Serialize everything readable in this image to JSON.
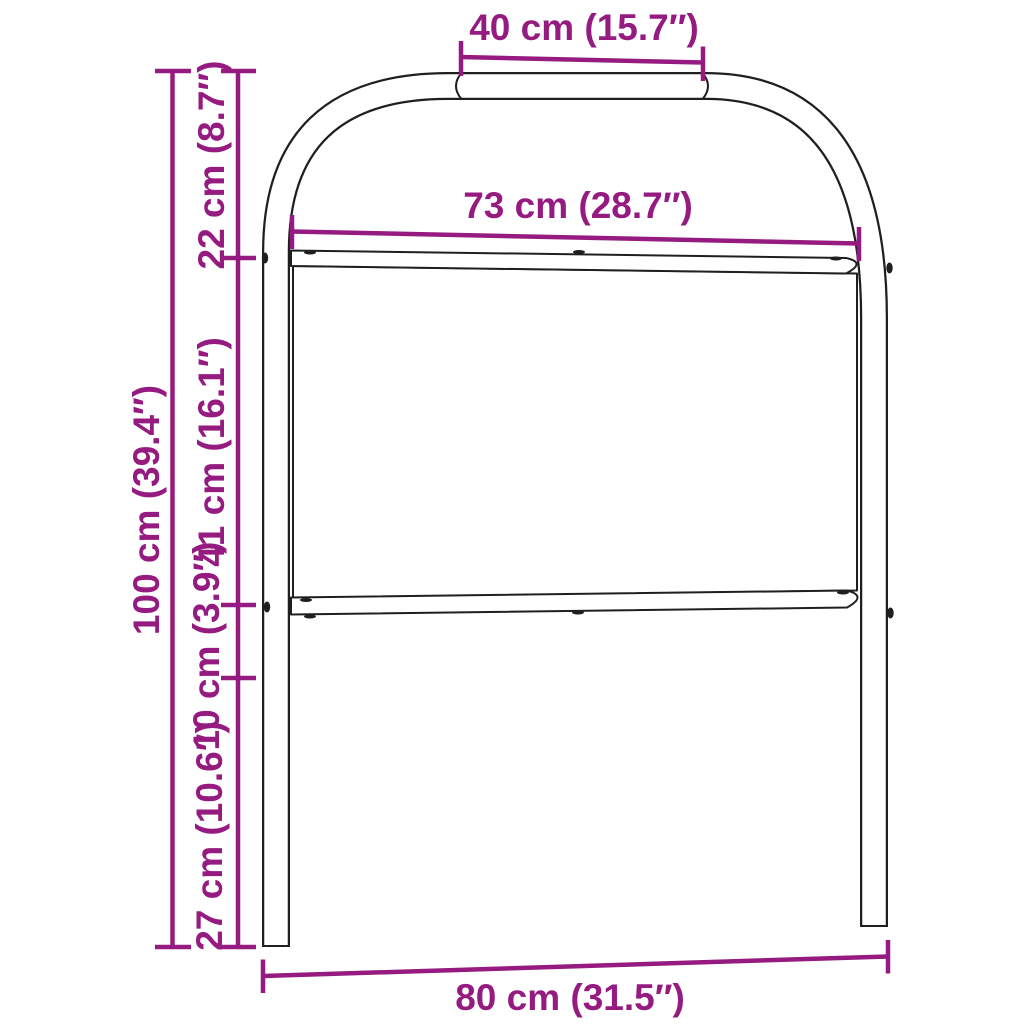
{
  "subject": "headboard-dimension-diagram",
  "measurements": {
    "top_width": {
      "label": "40 cm (15.7″)",
      "cm": 40,
      "inches": 15.7
    },
    "inner_width": {
      "label": "73 cm (28.7″)",
      "cm": 73,
      "inches": 28.7
    },
    "total_height": {
      "label": "100 cm (39.4″)",
      "cm": 100,
      "inches": 39.4
    },
    "upper_segment": {
      "label": "22 cm (8.7″)",
      "cm": 22,
      "inches": 8.7
    },
    "panel_height": {
      "label": "41 cm (16.1″)",
      "cm": 41,
      "inches": 16.1
    },
    "rail_segment": {
      "label": "10 cm (3.9″)",
      "cm": 10,
      "inches": 3.9
    },
    "leg_segment": {
      "label": "27 cm (10.6″)",
      "cm": 27,
      "inches": 10.6
    },
    "total_width": {
      "label": "80 cm (31.5″)",
      "cm": 80,
      "inches": 31.5
    }
  },
  "colors": {
    "dimension_accent": "#951b81",
    "frame_outline": "#1f1f1f",
    "background": "#ffffff"
  }
}
